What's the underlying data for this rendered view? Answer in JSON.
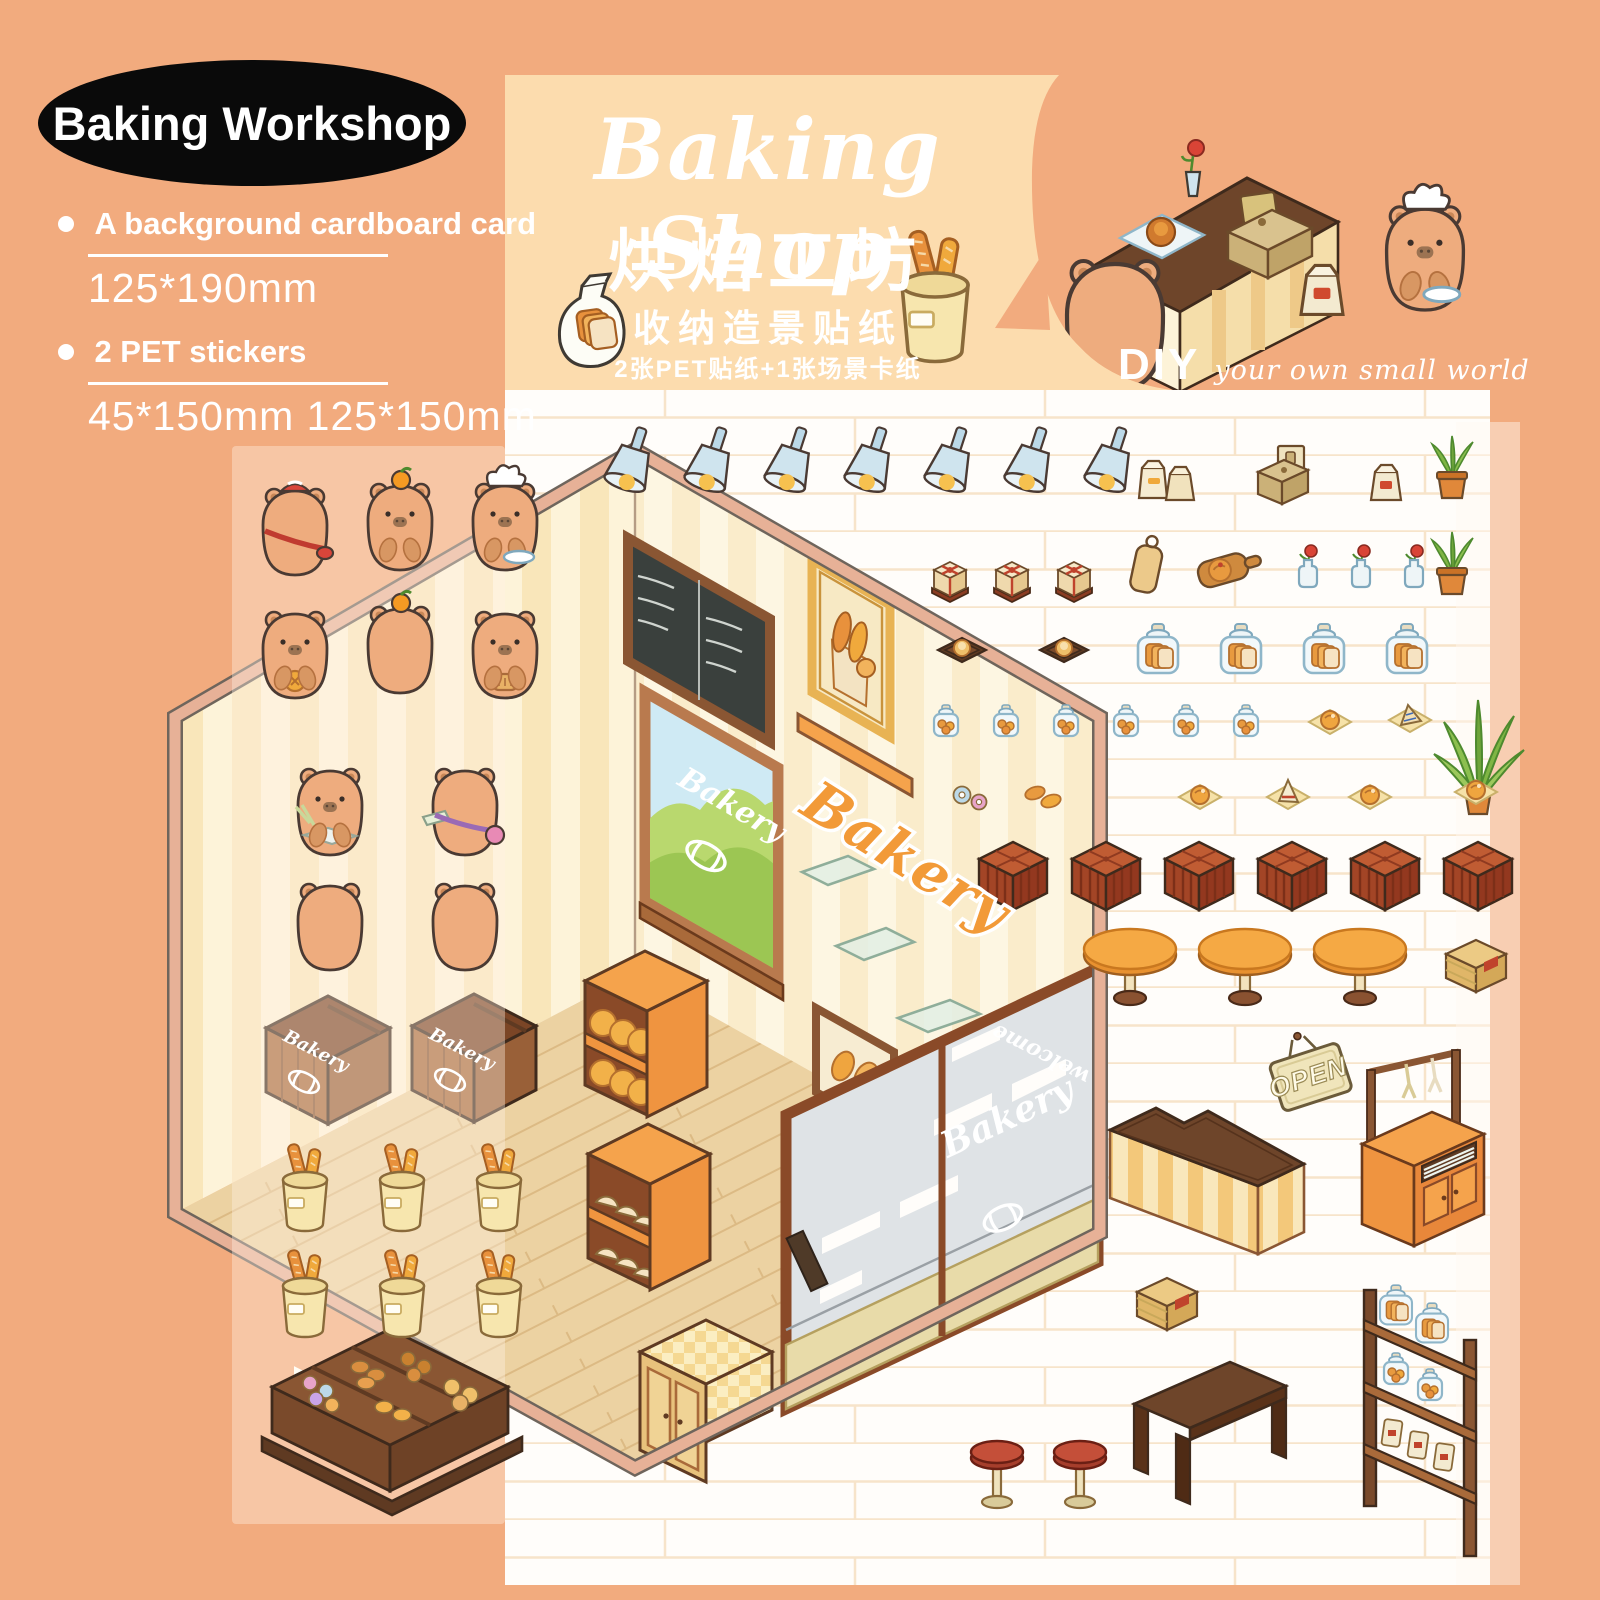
{
  "badge": {
    "label": "Baking Workshop"
  },
  "specs": {
    "item1": "A background cardboard card",
    "size1": "125*190mm",
    "item2": "2 PET stickers",
    "size2": "45*150mm 125*150mm"
  },
  "header": {
    "title_en": "Baking Shop",
    "title_cn": "烘焙工坊",
    "subtitle_cn": "收纳造景贴纸",
    "contents_cn": "2张PET贴纸+1张场景卡纸",
    "diy": "DIY",
    "diy_tagline": "your own small world"
  },
  "scene": {
    "window_label": "Bakery",
    "wall_label": "Bakery",
    "door_label": "Bakery",
    "box_label": "Bakery",
    "open_sign": "OPEN",
    "welcome_mat": "welcome"
  },
  "colors": {
    "background": "#f2ab7e",
    "header_band": "#fcdcae",
    "sheet": "#fffdfa",
    "accent_orange": "#f29a38",
    "wood_brown": "#8a5633",
    "capybara": "#eeac7e"
  },
  "stickers": {
    "rows": [
      {
        "name": "capybara-beret-back",
        "symbol": "capy-beret-back",
        "x": 295,
        "y": 535
      },
      {
        "name": "capybara-orange-hat",
        "symbol": "capy-orange-front",
        "x": 400,
        "y": 530
      },
      {
        "name": "capybara-chef",
        "symbol": "capy-chef-front",
        "x": 505,
        "y": 530
      },
      {
        "name": "capybara-cookie",
        "symbol": "capy-cookie-front",
        "x": 295,
        "y": 658
      },
      {
        "name": "capybara-orange-back",
        "symbol": "capy-orange-back",
        "x": 400,
        "y": 653
      },
      {
        "name": "capybara-bread",
        "symbol": "capy-bread-front",
        "x": 505,
        "y": 658
      },
      {
        "name": "capybara-baker-tray",
        "symbol": "capy-tray-front",
        "x": 330,
        "y": 815
      },
      {
        "name": "capybara-satchel-back",
        "symbol": "capy-satchel-back",
        "x": 465,
        "y": 815
      },
      {
        "name": "capybara-back",
        "symbol": "capy-back",
        "x": 330,
        "y": 930,
        "count": 2,
        "dx": 135
      },
      {
        "name": "spotlight",
        "symbol": "spotlight",
        "x": 628,
        "y": 472,
        "count": 7,
        "dx": 80
      },
      {
        "name": "paper-bags",
        "symbol": "paper-bags",
        "x": 1168,
        "y": 482
      },
      {
        "name": "cash-register-box",
        "symbol": "cash-box",
        "x": 1282,
        "y": 478
      },
      {
        "name": "bread-bag",
        "symbol": "small-bag",
        "x": 1386,
        "y": 484
      },
      {
        "name": "potted-plant",
        "symbol": "potted-plant",
        "x": 1452,
        "y": 470
      },
      {
        "name": "gift-box",
        "symbol": "gift-box",
        "x": 950,
        "y": 582,
        "count": 3,
        "dx": 62
      },
      {
        "name": "cutting-board",
        "symbol": "cutting-board",
        "x": 1146,
        "y": 570
      },
      {
        "name": "serving-board",
        "symbol": "serving-board",
        "x": 1224,
        "y": 570
      },
      {
        "name": "flower-vase",
        "symbol": "vase-flower",
        "x": 1308,
        "y": 568,
        "count": 3,
        "dx": 53
      },
      {
        "name": "potted-plant",
        "symbol": "potted-plant",
        "x": 1452,
        "y": 566
      },
      {
        "name": "bun-tray",
        "symbol": "tray-bun",
        "x": 962,
        "y": 650,
        "count": 2,
        "dx": 102
      },
      {
        "name": "bread-jar",
        "symbol": "bread-jar",
        "x": 1158,
        "y": 650,
        "count": 4,
        "dx": 83
      },
      {
        "name": "cookie-jar",
        "symbol": "cookie-jar",
        "x": 946,
        "y": 722,
        "count": 6,
        "dx": 60
      },
      {
        "name": "napkin-bun",
        "symbol": "napkin-bun",
        "x": 1330,
        "y": 722
      },
      {
        "name": "napkin-cake",
        "symbol": "napkin-cake",
        "x": 1410,
        "y": 718
      },
      {
        "name": "aloe-plant",
        "symbol": "aloe",
        "x": 1478,
        "y": 770
      },
      {
        "name": "donut-pair",
        "symbol": "donut-pair",
        "x": 970,
        "y": 797
      },
      {
        "name": "croissant-pair",
        "symbol": "croissant-pair",
        "x": 1042,
        "y": 795
      },
      {
        "name": "napkin-bun",
        "symbol": "napkin-bun",
        "x": 1200,
        "y": 797
      },
      {
        "name": "napkin-sandwich",
        "symbol": "napkin-sandwich",
        "x": 1288,
        "y": 795
      },
      {
        "name": "napkin-bun",
        "symbol": "napkin-bun",
        "x": 1370,
        "y": 797
      },
      {
        "name": "napkin-bun",
        "symbol": "napkin-bun",
        "x": 1476,
        "y": 792
      },
      {
        "name": "wicker-stool",
        "symbol": "basket-stool",
        "x": 1013,
        "y": 868,
        "count": 6,
        "dx": 93
      },
      {
        "name": "cafe-table",
        "symbol": "round-table",
        "x": 1130,
        "y": 968,
        "count": 3,
        "dx": 115
      },
      {
        "name": "wooden-crate",
        "symbol": "crate",
        "x": 1476,
        "y": 962
      },
      {
        "name": "open-sign",
        "symbol": "open-sign",
        "x": 1311,
        "y": 1078
      },
      {
        "name": "service-cart",
        "symbol": "service-cart",
        "x": 1422,
        "y": 1160
      },
      {
        "name": "l-counter",
        "symbol": "l-counter",
        "x": 1218,
        "y": 1180
      },
      {
        "name": "wooden-crate",
        "symbol": "crate",
        "x": 1167,
        "y": 1300
      },
      {
        "name": "bench",
        "symbol": "bench",
        "x": 1222,
        "y": 1430
      },
      {
        "name": "red-stool",
        "symbol": "stool-red",
        "x": 997,
        "y": 1478,
        "count": 2,
        "dx": 83
      },
      {
        "name": "bread-shelf",
        "symbol": "tall-shelf",
        "x": 1420,
        "y": 1398
      },
      {
        "name": "baguette-bucket",
        "symbol": "bucket",
        "x": 305,
        "y": 1190,
        "count": 3,
        "dx": 97
      },
      {
        "name": "baguette-bucket",
        "symbol": "bucket",
        "x": 305,
        "y": 1296,
        "count": 3,
        "dx": 97
      }
    ]
  }
}
